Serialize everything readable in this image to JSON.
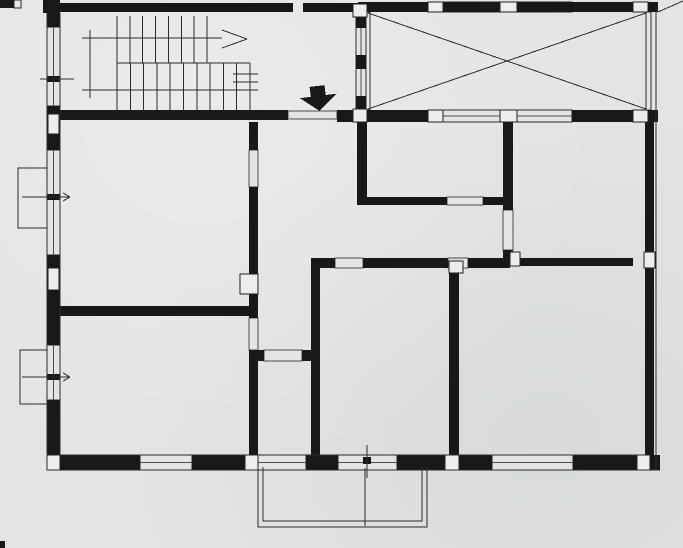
{
  "meta": {
    "title": "scanned-floor-plan",
    "canvas_w": 683,
    "canvas_h": 548
  },
  "palette": {
    "paper": "#e2e4e5",
    "ink": "#181818",
    "thin": "#2b2b2b",
    "soft": "#4a4d4f",
    "block_fill": "#eceded",
    "block_edge": "#202020"
  },
  "plan": {
    "outlines": [
      {
        "n": "bay-window-upper",
        "r": [
          18,
          168,
          29,
          60
        ]
      },
      {
        "n": "bay-window-lower",
        "r": [
          20,
          350,
          28,
          54
        ]
      },
      {
        "n": "terrace-left-edge",
        "r": [
          366,
          12,
          4,
          98
        ]
      },
      {
        "n": "terrace-right-edge",
        "r": [
          646,
          12,
          5,
          98
        ]
      },
      {
        "n": "top-left-stub-glazing",
        "r": [
          14,
          0,
          7,
          8
        ]
      }
    ],
    "windows": [
      {
        "n": "left-wall-window-stairhall",
        "r": [
          47,
          27,
          13,
          79
        ]
      },
      {
        "n": "left-wall-window-living",
        "r": [
          47,
          150,
          13,
          105
        ]
      },
      {
        "n": "left-wall-window-lower",
        "r": [
          47,
          345,
          13,
          55
        ]
      },
      {
        "n": "bottom-wall-window-1",
        "r": [
          140,
          455,
          52,
          15
        ]
      },
      {
        "n": "bottom-wall-window-2",
        "r": [
          258,
          455,
          48,
          15
        ]
      },
      {
        "n": "bottom-wall-french-door",
        "r": [
          338,
          455,
          59,
          15
        ]
      },
      {
        "n": "bottom-wall-window-3",
        "r": [
          492,
          455,
          81,
          15
        ]
      },
      {
        "n": "terrace-top-window-1",
        "r": [
          443,
          2,
          57,
          10
        ]
      },
      {
        "n": "terrace-top-window-2",
        "r": [
          517,
          2,
          55,
          10
        ]
      },
      {
        "n": "terrace-bottom-window-1",
        "r": [
          443,
          110,
          57,
          12
        ]
      },
      {
        "n": "terrace-bottom-window-2",
        "r": [
          517,
          110,
          55,
          12
        ]
      },
      {
        "n": "stair-glazed-partition",
        "r": [
          356,
          12,
          10,
          98
        ]
      }
    ],
    "openings": [
      {
        "n": "entrance-door-opening",
        "r": [
          288,
          111,
          49,
          8
        ]
      },
      {
        "n": "door-living-to-hall",
        "r": [
          249,
          150,
          9,
          37
        ]
      },
      {
        "n": "door-hall-to-lower-left-room",
        "r": [
          249,
          318,
          9,
          32
        ]
      },
      {
        "n": "door-hall-to-bathroom",
        "r": [
          264,
          350,
          38,
          11
        ]
      },
      {
        "n": "opening-middle-room",
        "r": [
          335,
          258,
          28,
          10
        ]
      },
      {
        "n": "door-to-bottom-right-room",
        "r": [
          448,
          258,
          20,
          10
        ]
      },
      {
        "n": "door-to-top-right-room",
        "r": [
          503,
          210,
          10,
          40
        ]
      },
      {
        "n": "door-to-kitchen",
        "r": [
          447,
          197,
          36,
          8
        ]
      }
    ],
    "walls": [
      {
        "n": "top-wall-stair-block-a",
        "r": [
          58,
          3,
          235,
          9
        ]
      },
      {
        "n": "top-wall-stair-block-b",
        "r": [
          303,
          3,
          55,
          9
        ]
      },
      {
        "n": "top-wall-terrace",
        "r": [
          358,
          2,
          300,
          10
        ]
      },
      {
        "n": "top-left-stub-a",
        "r": [
          0,
          0,
          14,
          8
        ]
      },
      {
        "n": "top-left-stub-b",
        "r": [
          43,
          0,
          17,
          13
        ]
      },
      {
        "n": "left-wall-pier-1",
        "r": [
          47,
          13,
          13,
          14
        ]
      },
      {
        "n": "left-wall-pier-2",
        "r": [
          47,
          106,
          13,
          44
        ]
      },
      {
        "n": "left-wall-pier-3",
        "r": [
          47,
          255,
          13,
          90
        ]
      },
      {
        "n": "left-wall-pier-4",
        "r": [
          47,
          400,
          13,
          55
        ]
      },
      {
        "n": "bottom-wall-pier-1",
        "r": [
          60,
          455,
          80,
          15
        ]
      },
      {
        "n": "bottom-wall-pier-2",
        "r": [
          192,
          455,
          53,
          15
        ]
      },
      {
        "n": "bottom-wall-pier-3",
        "r": [
          306,
          455,
          32,
          15
        ]
      },
      {
        "n": "bottom-wall-pier-4",
        "r": [
          397,
          455,
          48,
          15
        ]
      },
      {
        "n": "bottom-wall-pier-5",
        "r": [
          459,
          455,
          33,
          15
        ]
      },
      {
        "n": "bottom-wall-pier-6",
        "r": [
          573,
          455,
          64,
          15
        ]
      },
      {
        "n": "bottom-wall-corner",
        "r": [
          650,
          455,
          10,
          15
        ]
      },
      {
        "n": "right-wall-upper",
        "r": [
          645,
          110,
          9,
          142
        ]
      },
      {
        "n": "right-wall-lower",
        "r": [
          645,
          268,
          9,
          187
        ]
      },
      {
        "n": "stairhall-bottom-wall",
        "r": [
          58,
          110,
          230,
          10
        ]
      },
      {
        "n": "stairhall-bottom-wall-end",
        "r": [
          337,
          110,
          16,
          12
        ]
      },
      {
        "n": "terrace-bottom-wall-a",
        "r": [
          366,
          110,
          62,
          12
        ]
      },
      {
        "n": "terrace-bottom-wall-b",
        "r": [
          572,
          110,
          61,
          12
        ]
      },
      {
        "n": "terrace-bottom-wall-c",
        "r": [
          648,
          110,
          10,
          12
        ]
      },
      {
        "n": "hall-wall-a-upper",
        "r": [
          249,
          122,
          9,
          28
        ]
      },
      {
        "n": "hall-wall-a-mid",
        "r": [
          249,
          187,
          9,
          131
        ]
      },
      {
        "n": "hall-wall-a-lower",
        "r": [
          249,
          350,
          9,
          105
        ]
      },
      {
        "n": "flue-edge",
        "r": [
          240,
          286,
          7,
          8
        ]
      },
      {
        "n": "wall-b-horizontal",
        "r": [
          58,
          306,
          200,
          10
        ]
      },
      {
        "n": "bathroom-wall-a",
        "r": [
          258,
          350,
          6,
          11
        ]
      },
      {
        "n": "bathroom-wall-b",
        "r": [
          302,
          350,
          9,
          11
        ]
      },
      {
        "n": "wall-c-vertical",
        "r": [
          311,
          258,
          9,
          197
        ]
      },
      {
        "n": "middle-room-top-wall-a",
        "r": [
          311,
          258,
          24,
          10
        ]
      },
      {
        "n": "middle-room-top-wall-b",
        "r": [
          363,
          258,
          85,
          10
        ]
      },
      {
        "n": "corridor-south-wall",
        "r": [
          468,
          258,
          42,
          10
        ]
      },
      {
        "n": "top-right-room-bottom-wall",
        "r": [
          520,
          258,
          113,
          8
        ]
      },
      {
        "n": "wall-d-upper",
        "r": [
          503,
          122,
          10,
          88
        ]
      },
      {
        "n": "wall-d-lower",
        "r": [
          503,
          250,
          10,
          16
        ]
      },
      {
        "n": "wall-e-a",
        "r": [
          358,
          197,
          89,
          8
        ]
      },
      {
        "n": "wall-e-b",
        "r": [
          483,
          197,
          20,
          8
        ]
      },
      {
        "n": "wall-f-vertical",
        "r": [
          357,
          122,
          10,
          83
        ]
      },
      {
        "n": "wall-g-vertical",
        "r": [
          449,
          266,
          10,
          189
        ]
      },
      {
        "n": "glazing-mullion-1",
        "r": [
          356,
          12,
          10,
          16
        ]
      },
      {
        "n": "glazing-mullion-2",
        "r": [
          356,
          55,
          10,
          14
        ]
      },
      {
        "n": "glazing-mullion-3",
        "r": [
          356,
          96,
          10,
          16
        ]
      },
      {
        "n": "scan-edge-mark",
        "r": [
          0,
          541,
          5,
          7
        ]
      }
    ],
    "blocks": [
      {
        "n": "top-wall-mullion-1",
        "r": [
          428,
          2,
          15,
          10
        ]
      },
      {
        "n": "top-wall-mullion-2",
        "r": [
          500,
          2,
          17,
          10
        ]
      },
      {
        "n": "top-wall-mullion-3",
        "r": [
          633,
          2,
          15,
          10
        ]
      },
      {
        "n": "left-wall-block-1",
        "r": [
          48,
          114,
          11,
          20
        ]
      },
      {
        "n": "left-wall-block-2",
        "r": [
          48,
          268,
          11,
          22
        ]
      },
      {
        "n": "bottom-wall-block-1",
        "r": [
          47,
          455,
          13,
          15
        ]
      },
      {
        "n": "bottom-wall-block-2",
        "r": [
          245,
          455,
          13,
          15
        ]
      },
      {
        "n": "bottom-wall-block-3",
        "r": [
          445,
          455,
          14,
          15
        ]
      },
      {
        "n": "bottom-wall-block-4",
        "r": [
          637,
          455,
          13,
          15
        ]
      },
      {
        "n": "right-wall-block",
        "r": [
          644,
          252,
          11,
          16
        ]
      },
      {
        "n": "terrace-bwall-block-1",
        "r": [
          428,
          110,
          15,
          12
        ]
      },
      {
        "n": "terrace-bwall-block-2",
        "r": [
          500,
          110,
          17,
          12
        ]
      },
      {
        "n": "terrace-bwall-block-3",
        "r": [
          633,
          110,
          15,
          12
        ]
      },
      {
        "n": "corridor-block",
        "r": [
          510,
          252,
          10,
          14
        ]
      },
      {
        "n": "wall-g-top-block",
        "r": [
          449,
          261,
          14,
          12
        ]
      },
      {
        "n": "glazing-junction-top",
        "r": [
          353,
          4,
          14,
          13
        ]
      },
      {
        "n": "glazing-junction-bottom",
        "r": [
          353,
          109,
          14,
          13
        ]
      },
      {
        "n": "flue-block",
        "r": [
          240,
          274,
          18,
          20
        ]
      }
    ],
    "inkmarks": [
      {
        "n": "window-axis-mark-stairhall",
        "r": [
          47,
          76,
          13,
          6
        ]
      },
      {
        "n": "window-axis-mark-bay1",
        "r": [
          47,
          194,
          13,
          6
        ]
      },
      {
        "n": "window-axis-mark-bay2",
        "r": [
          47,
          374,
          13,
          6
        ]
      },
      {
        "n": "door-axis-mark-balcony",
        "r": [
          363,
          457,
          8,
          7
        ]
      }
    ],
    "lines": [
      {
        "n": "left-wall-outer-face",
        "p": [
          47,
          13,
          47,
          470
        ]
      },
      {
        "n": "left-wall-inner-face",
        "p": [
          60,
          13,
          60,
          455
        ]
      },
      {
        "n": "bottom-wall-outer-face",
        "p": [
          47,
          470,
          660,
          470
        ]
      },
      {
        "n": "bottom-wall-inner-face",
        "p": [
          60,
          455,
          645,
          455
        ]
      },
      {
        "n": "right-wall-outer-face",
        "p": [
          656,
          12,
          656,
          470
        ]
      },
      {
        "n": "terrace-diagonal-1",
        "p": [
          368,
          13,
          646,
          109
        ]
      },
      {
        "n": "terrace-diagonal-2",
        "p": [
          368,
          109,
          646,
          13
        ]
      },
      {
        "n": "stair-walk-line-up",
        "p": [
          82,
          38,
          222,
          38
        ]
      },
      {
        "n": "stair-arrow-head-a",
        "p": [
          222,
          30,
          247,
          39
        ]
      },
      {
        "n": "stair-arrow-head-b",
        "p": [
          222,
          48,
          247,
          39
        ]
      },
      {
        "n": "stair-walk-line-low",
        "p": [
          82,
          90,
          252,
          90
        ]
      },
      {
        "n": "stair-walk-line-turn",
        "p": [
          90,
          30,
          90,
          98
        ]
      },
      {
        "n": "axis-line-stairhall-window",
        "p": [
          40,
          79,
          74,
          79
        ]
      },
      {
        "n": "axis-line-bay1",
        "p": [
          22,
          197,
          70,
          197
        ]
      },
      {
        "n": "axis-arrow-bay1-a",
        "p": [
          70,
          197,
          63,
          193
        ]
      },
      {
        "n": "axis-arrow-bay1-b",
        "p": [
          70,
          197,
          63,
          201
        ]
      },
      {
        "n": "axis-line-bay2",
        "p": [
          22,
          377,
          70,
          377
        ]
      },
      {
        "n": "axis-arrow-bay2-a",
        "p": [
          70,
          377,
          63,
          373
        ]
      },
      {
        "n": "axis-arrow-bay2-b",
        "p": [
          70,
          377,
          63,
          381
        ]
      },
      {
        "n": "axis-line-balcony-door",
        "p": [
          367,
          445,
          367,
          478
        ]
      },
      {
        "n": "balcony-divider",
        "p": [
          365,
          468,
          365,
          526
        ]
      },
      {
        "n": "scan-artifact-line",
        "p": [
          658,
          12,
          683,
          1
        ]
      }
    ],
    "stairs": {
      "n": "staircase",
      "flights": [
        {
          "n": "upper-flight-treads",
          "x1": 117,
          "x2": 207,
          "count": 8,
          "y1": 16,
          "y2": 63
        },
        {
          "n": "lower-flight-treads",
          "x1": 117,
          "x2": 250,
          "count": 11,
          "y1": 63,
          "y2": 110
        }
      ],
      "divider": [
        117,
        63,
        250,
        63
      ],
      "breaks": [
        [
          233,
          74,
          258,
          74
        ],
        [
          233,
          82,
          258,
          82
        ],
        [
          233,
          90,
          258,
          90
        ]
      ]
    },
    "polylines": [
      {
        "n": "balcony-outer-rail",
        "pts": "258,467 258,527 427,527 427,467"
      },
      {
        "n": "balcony-inner-rail",
        "pts": "263,467 263,521 422,521 422,467"
      }
    ],
    "arrow": {
      "n": "entrance-arrow",
      "points": "311,86 326,86 326,96 337,96 318,111 300,96 311,96",
      "rotate": [
        -7,
        318,
        98
      ]
    }
  }
}
